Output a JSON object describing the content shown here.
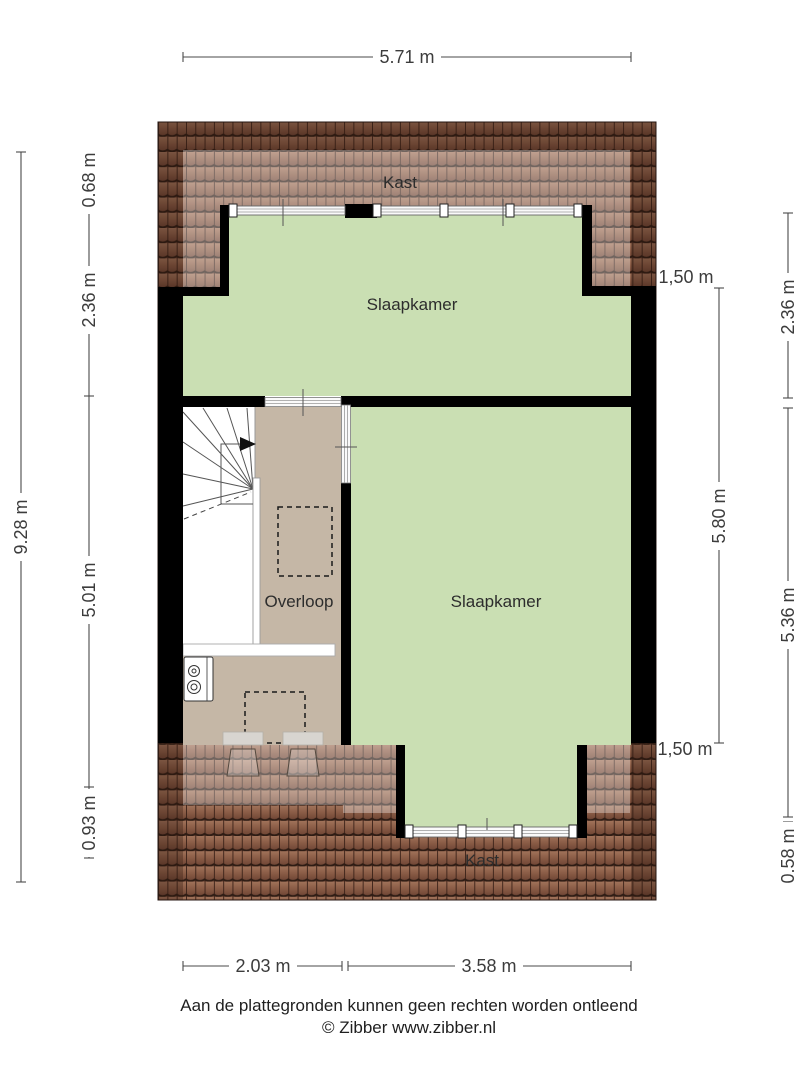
{
  "floorplan": {
    "labels": {
      "kast_top": "Kast",
      "slaapkamer_top": "Slaapkamer",
      "overloop": "Overloop",
      "slaapkamer_bottom": "Slaapkamer",
      "kast_bottom": "Kast"
    },
    "dims": {
      "top": "5.71 m",
      "left_total": "9.28 m",
      "left_0": "0.68 m",
      "left_1": "2.36 m",
      "left_2": "5.01 m",
      "left_3": "0.93 m",
      "right_cap_top": "1,50 m",
      "right_cap_bottom": "1,50 m",
      "right_inner": "5.80 m",
      "right_0": "2.36 m",
      "right_1": "5.36 m",
      "right_2": "0.58 m",
      "bottom_0": "2.03 m",
      "bottom_1": "3.58 m"
    },
    "colors": {
      "room_green": "#cadfb3",
      "hall_tan": "#c5b7a6",
      "roof_brown": "#8a5c46",
      "wall": "#000000",
      "dimension_line": "#4a4a4a"
    }
  },
  "footer": {
    "disclaimer": "Aan de plattegronden kunnen geen rechten worden ontleend",
    "copyright": "© Zibber www.zibber.nl"
  }
}
